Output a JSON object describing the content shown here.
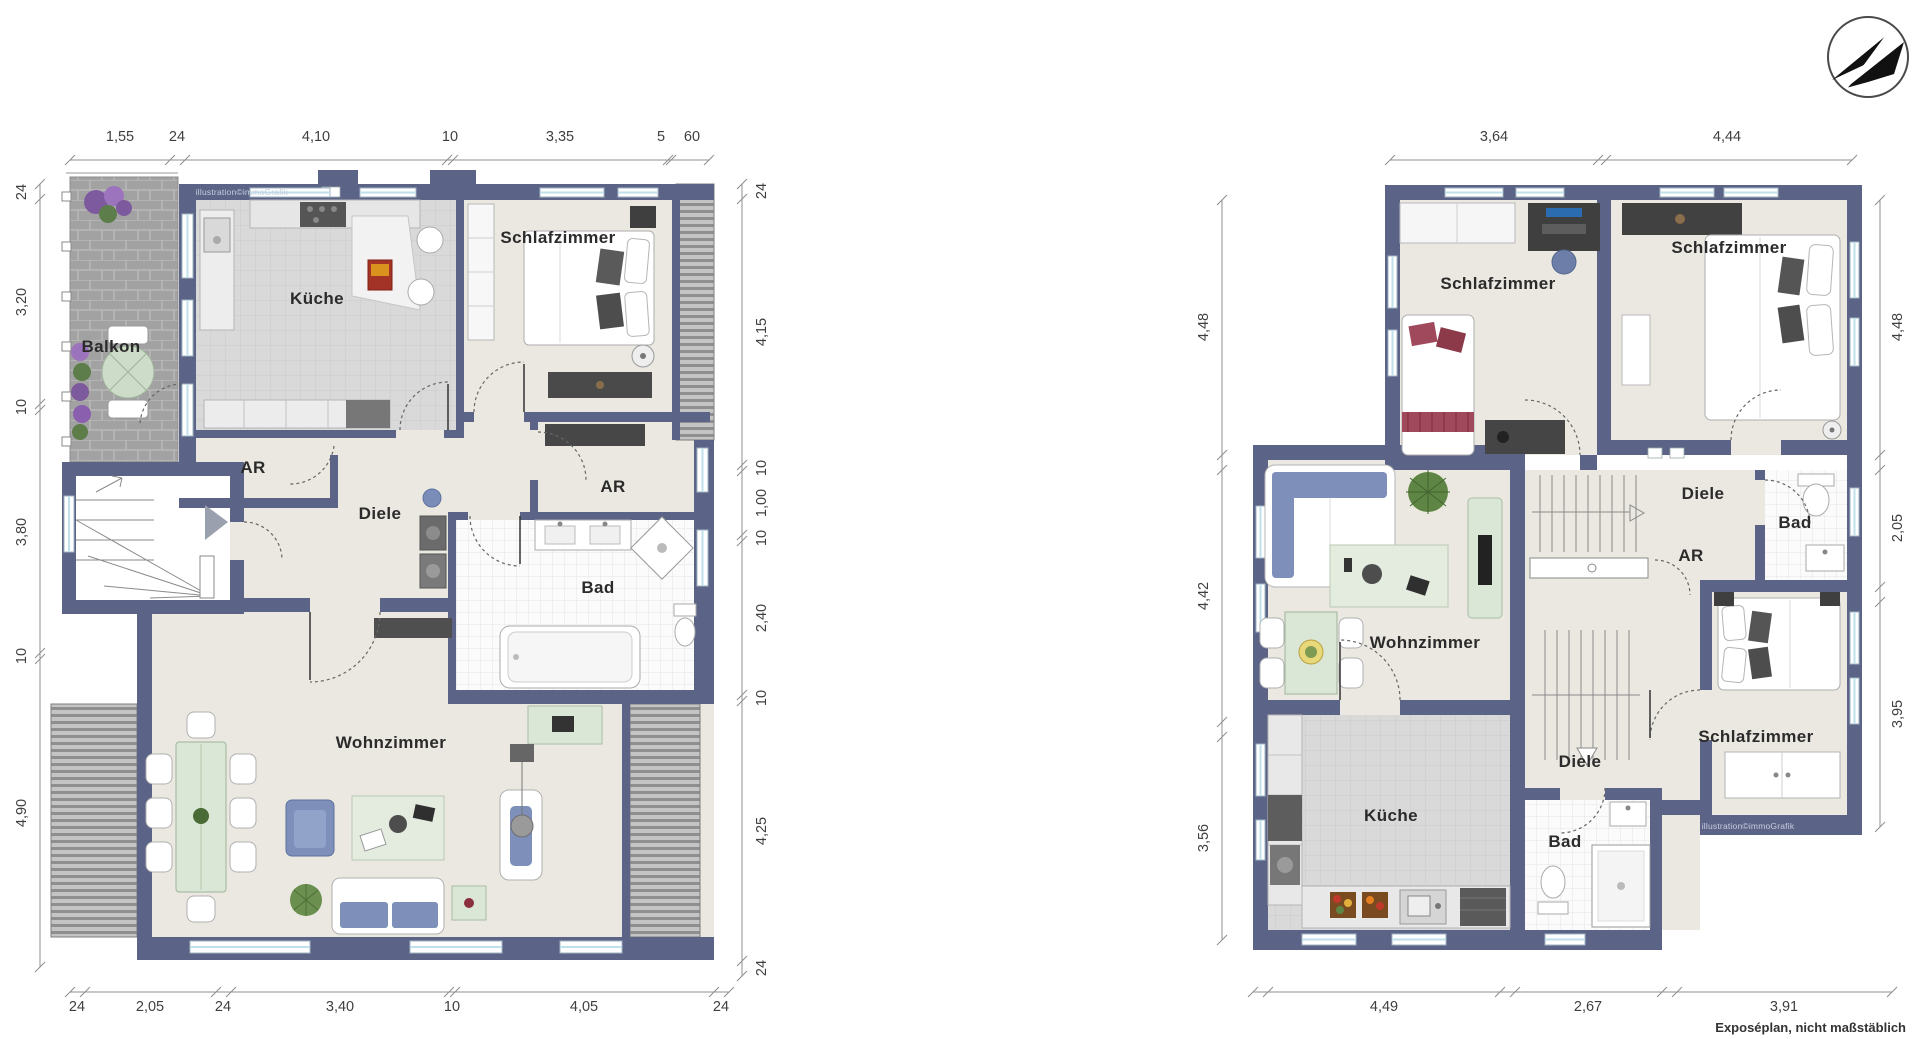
{
  "page": {
    "background": "#ffffff",
    "footer_note": "Exposéplan, nicht maßstäblich",
    "watermark": "illustration©immoGrafik"
  },
  "colors": {
    "wall": "#5b6387",
    "floor": "#eae8e1",
    "kitchen_tile": "#d9d9d9",
    "bath_tile": "#fbfbfb",
    "paving": "#a2a2a2",
    "sofa_blue": "#7e90ba",
    "furniture_green": "#dbe7d6",
    "dim_text": "#3f3f3f"
  },
  "compass": {
    "icon": "north-arrow-icon"
  },
  "plans": {
    "left": {
      "rooms": {
        "balkon": "Balkon",
        "kueche": "Küche",
        "schlafzimmer": "Schlafzimmer",
        "ar1": "AR",
        "diele": "Diele",
        "ar2": "AR",
        "bad": "Bad",
        "wohnzimmer": "Wohnzimmer"
      },
      "dims": {
        "top": [
          "1,55",
          "24",
          "4,10",
          "10",
          "3,35",
          "5",
          "60"
        ],
        "left": [
          "24",
          "3,20",
          "10",
          "3,80",
          "10",
          "4,90"
        ],
        "right": [
          "24",
          "4,15",
          "10",
          "1,00",
          "10",
          "2,40",
          "10",
          "4,25",
          "24"
        ],
        "bottom": [
          "24",
          "2,05",
          "24",
          "3,40",
          "10",
          "4,05",
          "24"
        ]
      }
    },
    "right": {
      "rooms": {
        "schlafzimmer1": "Schlafzimmer",
        "schlafzimmer2": "Schlafzimmer",
        "diele1": "Diele",
        "bad1": "Bad",
        "ar": "AR",
        "wohnzimmer": "Wohnzimmer",
        "diele2": "Diele",
        "kueche": "Küche",
        "bad2": "Bad",
        "schlafzimmer3": "Schlafzimmer"
      },
      "dims": {
        "top": [
          "3,64",
          "4,44"
        ],
        "left": [
          "4,48",
          "4,42",
          "3,56"
        ],
        "right": [
          "4,48",
          "2,05",
          "3,95"
        ],
        "bottom": [
          "4,49",
          "2,67",
          "3,91"
        ]
      }
    }
  }
}
